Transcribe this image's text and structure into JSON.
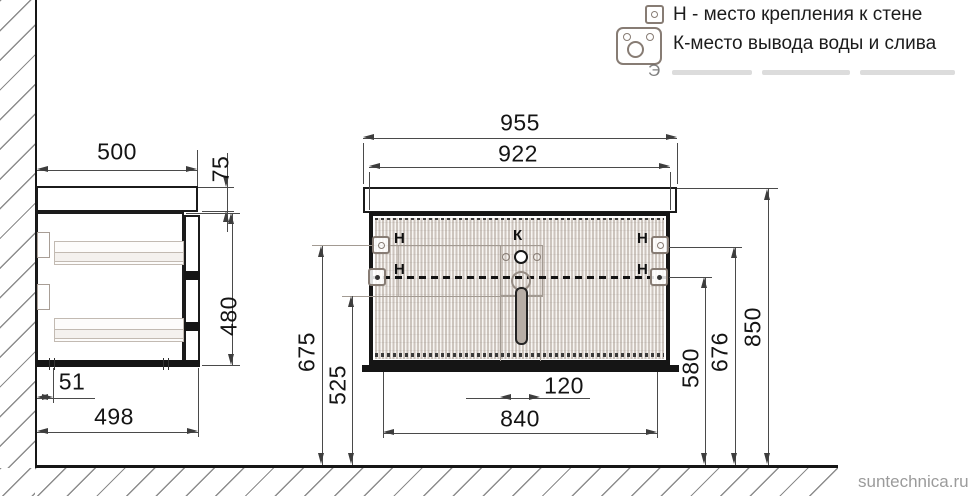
{
  "legend": {
    "items": [
      {
        "icon": "wall-mount-icon",
        "label": "Н - место крепления к стене"
      },
      {
        "icon": "drain-icon",
        "label": "К-место вывода воды и слива"
      }
    ],
    "faded_line_start": "Э"
  },
  "side_view": {
    "depth": "500",
    "countertop_height": "75",
    "cabinet_height": "480",
    "bottom_back_offset": "51",
    "bottom_depth": "498"
  },
  "front_view": {
    "countertop_width": "955",
    "cabinet_width": "922",
    "mount_upper_left_height": "675",
    "drain_zone_bottom_height": "525",
    "drain_zone_width": "120",
    "mount_spacing": "840",
    "mount_lower_height": "580",
    "mount_upper_right_height": "676",
    "total_height": "850",
    "mount_label": "Н",
    "drain_label": "К"
  },
  "watermark": "suntechnica.ru",
  "colors": {
    "drawing_line": "#1b1b1b",
    "dimension_line": "#4a4a4a",
    "flute_fill": "#cdc5bf",
    "marker_outline": "#877c74"
  }
}
